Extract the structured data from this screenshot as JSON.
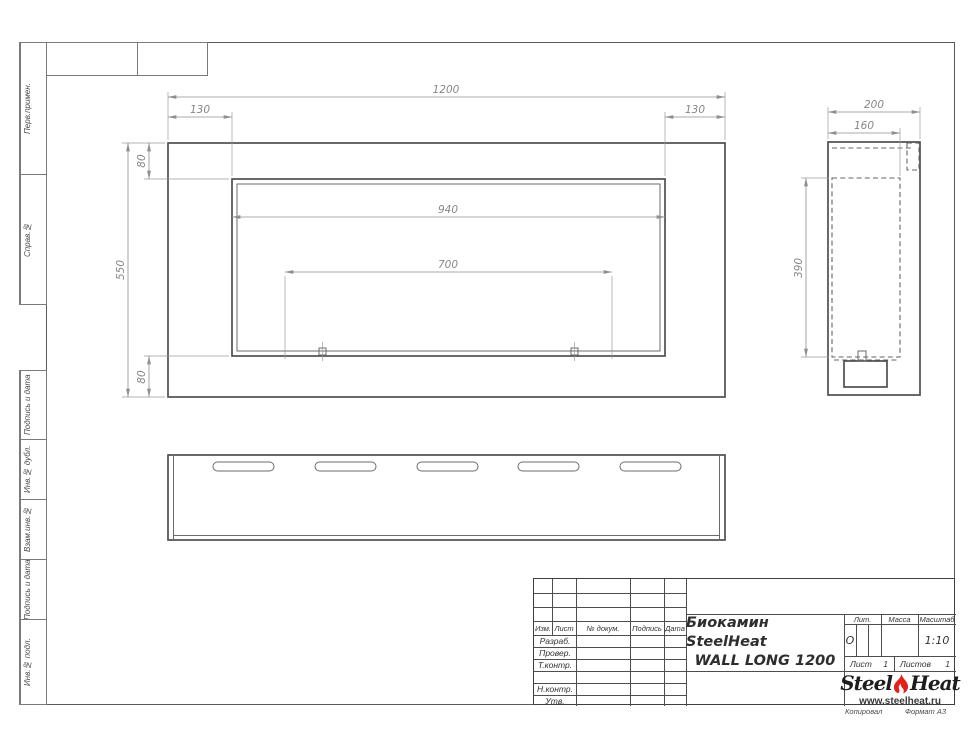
{
  "frame": {
    "vertical_labels": [
      "Перв.примен.",
      "Справ.№",
      "Подпись и дата",
      "Инв.№ дубл.",
      "Взам.инв.№",
      "Подпись и дата",
      "Инв.№ подл."
    ]
  },
  "dims": {
    "front_width": "1200",
    "front_inset_left": "130",
    "front_inset_right": "130",
    "front_opening_width": "940",
    "front_burner_span": "700",
    "front_height": "550",
    "front_top_margin": "80",
    "front_bottom_margin": "80",
    "side_depth": "200",
    "side_inner_depth": "160",
    "side_opening_height": "390"
  },
  "title_block": {
    "col_headers": [
      "Изм.",
      "Лист",
      "№ докум.",
      "Подпись",
      "Дата"
    ],
    "row_labels": [
      "Разраб.",
      "Провер.",
      "Т.контр.",
      "Н.контр.",
      "Утв."
    ],
    "title_line1": "Биокамин SteelHeat",
    "title_line2": "WALL LONG 1200",
    "lit_label": "Лит.",
    "lit_value": "О",
    "mass_label": "Масса",
    "scale_label": "Масштаб",
    "scale_value": "1:10",
    "sheet_label": "Лист",
    "sheet_num": "1",
    "sheets_label": "Листов",
    "sheets_num": "1",
    "logo_part1": "Steel",
    "logo_part2": "Heat",
    "logo_site": "www.steelheat.ru",
    "copy_label": "Копировал",
    "format_label": "Формат А3"
  }
}
